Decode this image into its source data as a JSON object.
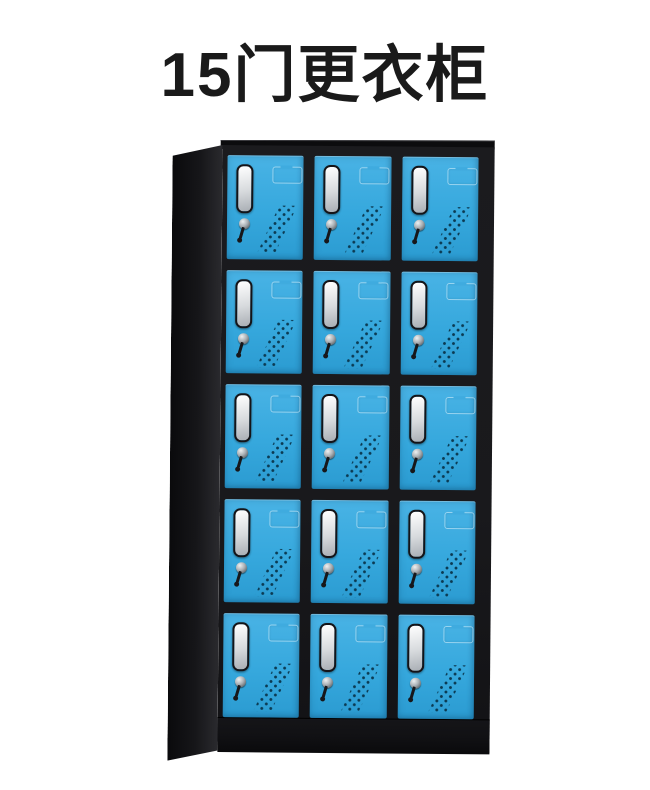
{
  "title": {
    "text": "15门更衣柜"
  },
  "cabinet": {
    "rows": 5,
    "cols": 3,
    "door_count": 15,
    "door_features": [
      "handle-recess-icon",
      "key-lock-icon",
      "hanging-key-icon",
      "label-emboss-icon",
      "vent-holes-icon"
    ],
    "colors": {
      "page_bg": "#ffffff",
      "title_color": "#1a1a1a",
      "door_blue": "#36a8dd",
      "door_blue_light": "#49b3e5",
      "door_blue_dark": "#2b9bd1",
      "frame_black": "#19191c",
      "frame_deep": "#0c0c0e",
      "side_front": "#2a2a2e",
      "side_back": "#0a0a0c",
      "plinth": "#111114",
      "handle_border": "#141418",
      "handle_light": "#ffffff",
      "handle_mid": "#d7dadd",
      "handle_dark": "#a9aeb4",
      "lock_light": "#eef1f2",
      "lock_dark": "#3a3f44",
      "key_black": "#17171a",
      "vent_dot": "#0b3a52",
      "emboss_line": "#dff3fc8c",
      "emboss_gap": "#3fabdf"
    }
  }
}
